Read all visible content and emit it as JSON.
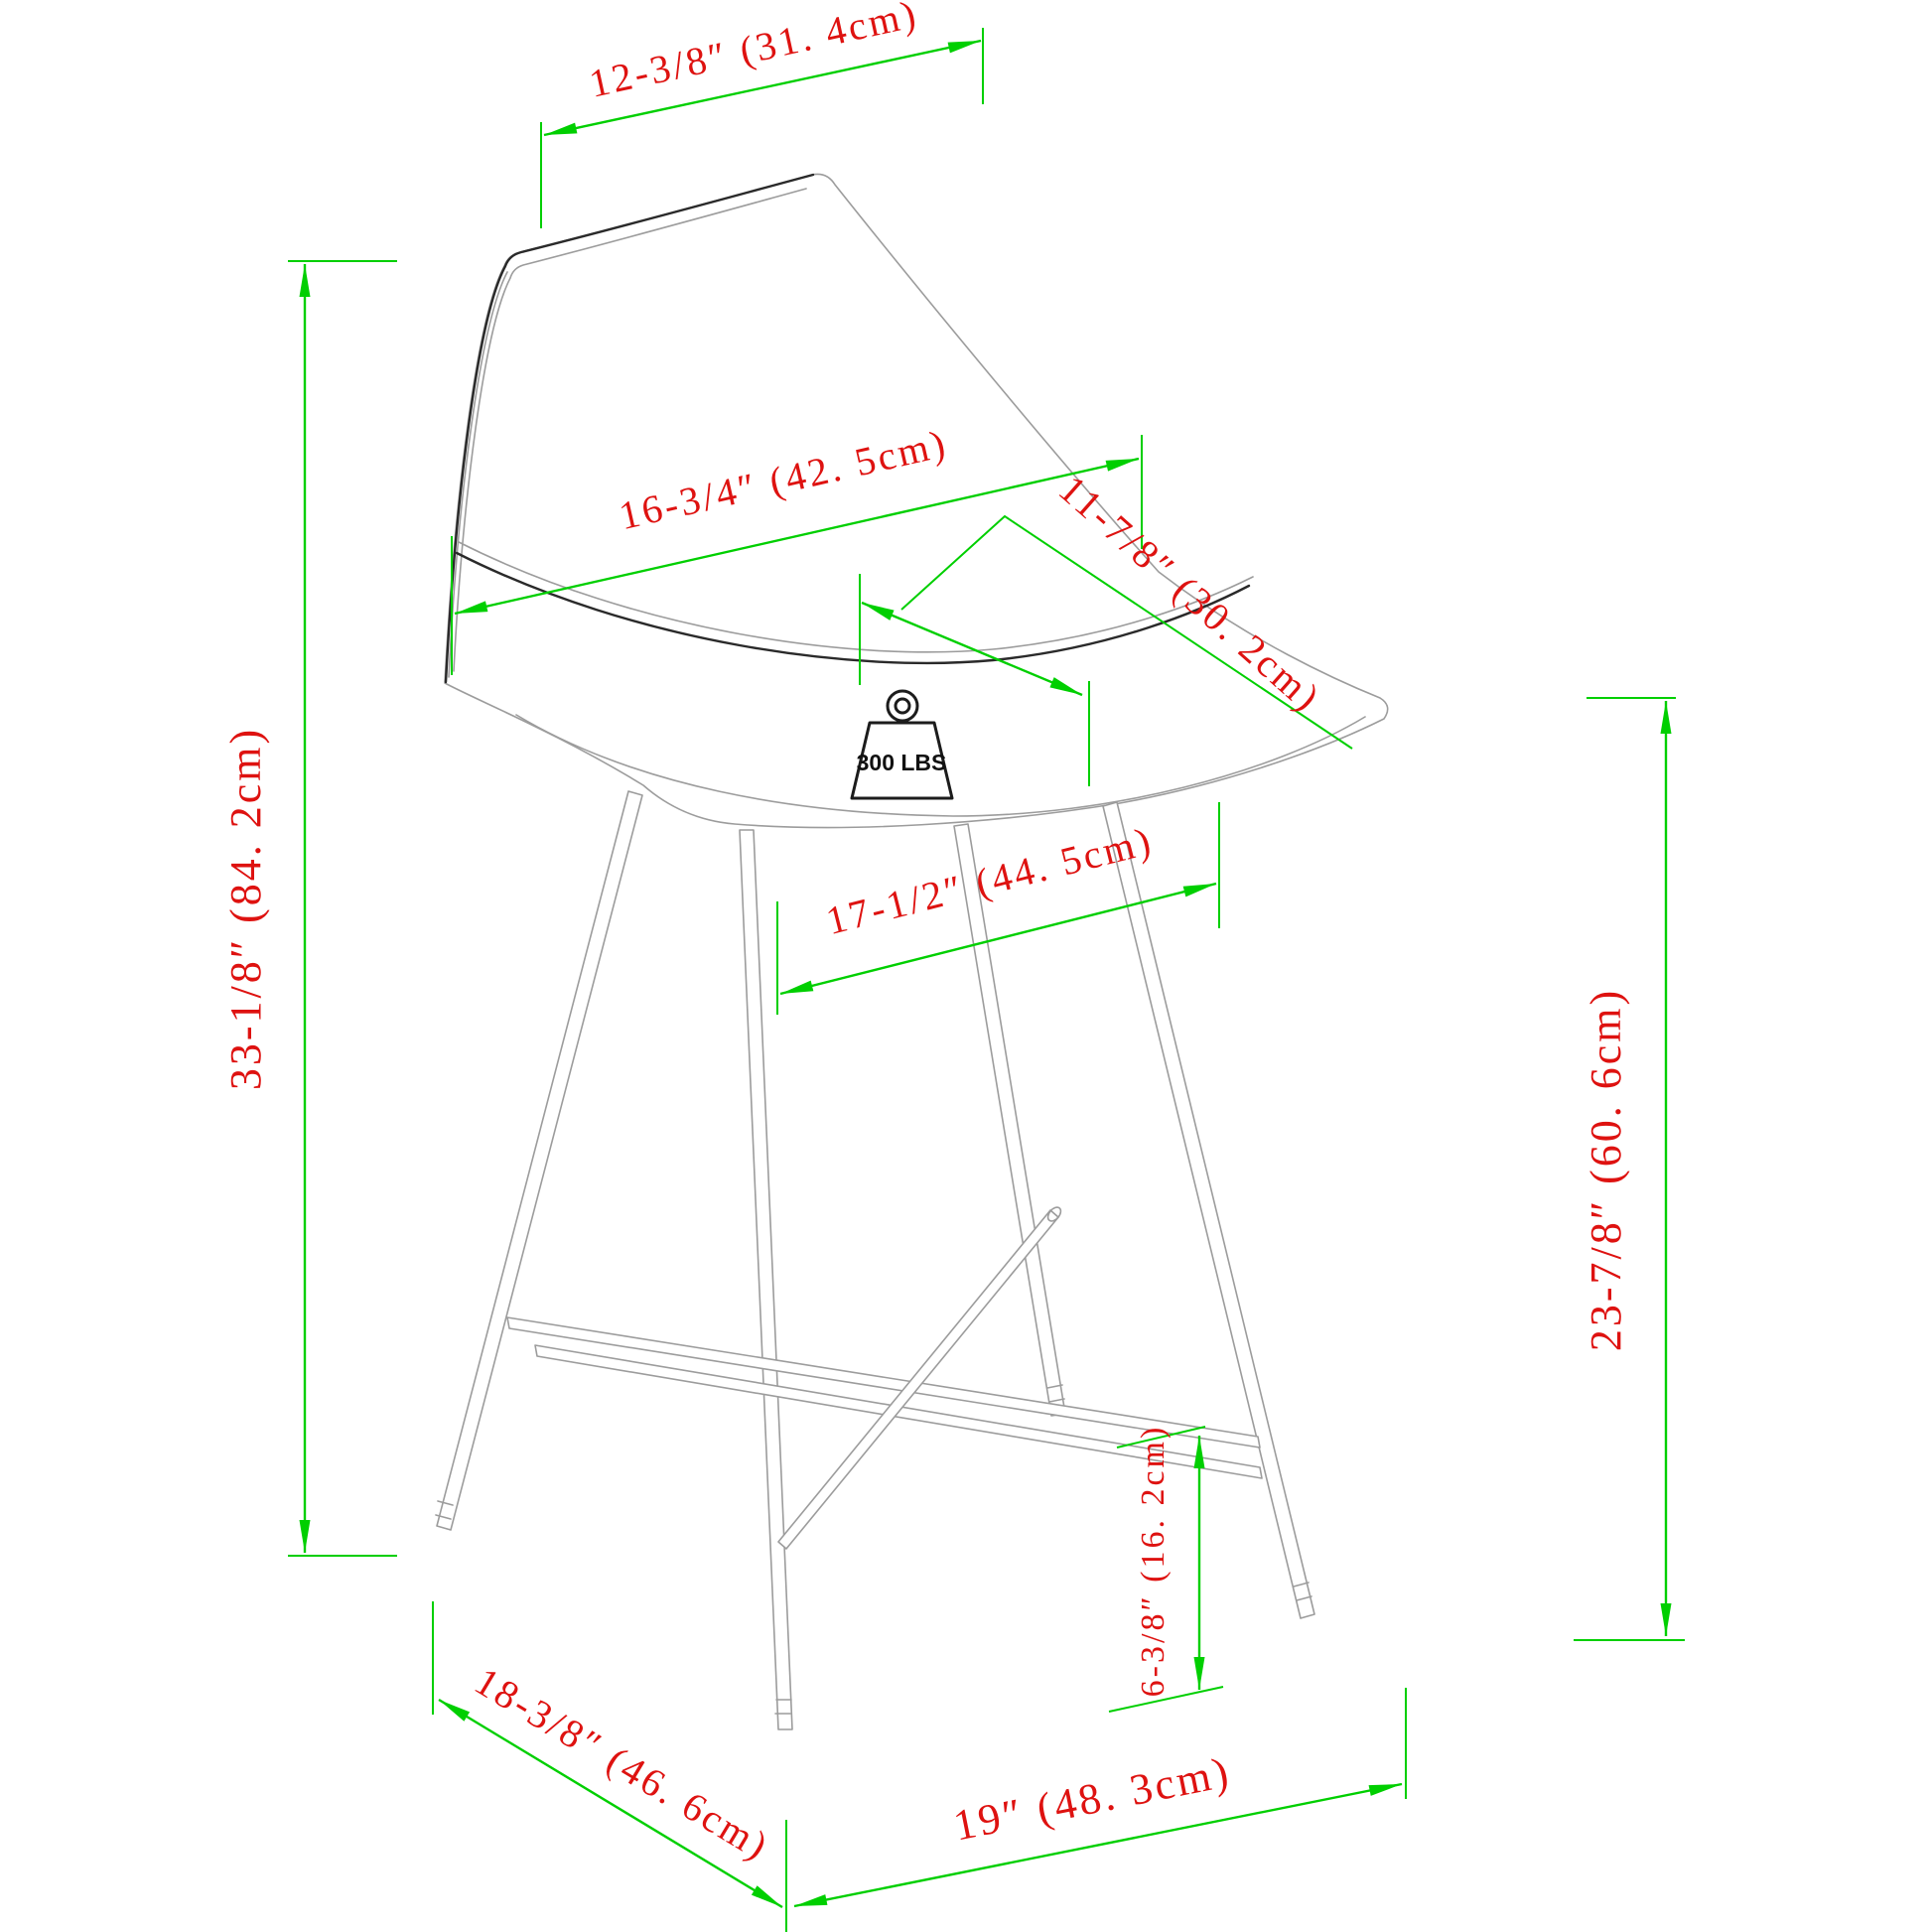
{
  "diagram": {
    "colors": {
      "dimension_line": "#00CF00",
      "dimension_text": "#DE1210",
      "drawing": "#9C9C9C",
      "accent": "#2A2A2A"
    },
    "weight_capacity": "300 LBS",
    "dimensions": {
      "back_top_width": "12-3/8″ (31. 4cm)",
      "backrest_width": "16-3/4″ (42. 5cm)",
      "seat_depth": "11-7/8″ (30. 2cm)",
      "seat_width": "17-1/2″ (44. 5cm)",
      "overall_height": "33-1/8″ (84. 2cm)",
      "seat_height": "23-7/8″ (60. 6cm)",
      "footrest_height": "6-3/8″ (16. 2cm)",
      "base_depth": "18-3/8″ (46. 6cm)",
      "base_width": "19″ (48. 3cm)"
    }
  }
}
